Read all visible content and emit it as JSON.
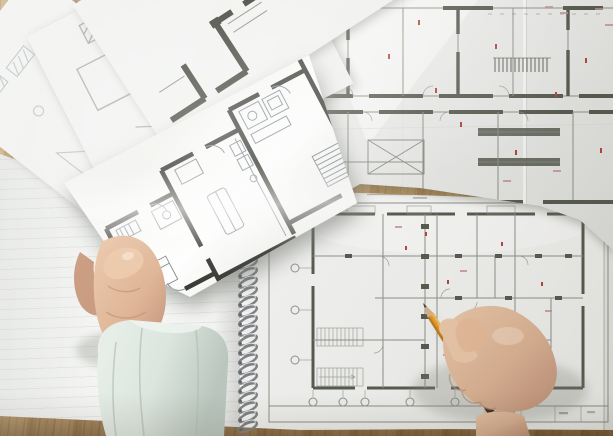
{
  "scene": {
    "description": "Top view of an architect's desk: a left hand holds a small white sheet with a bold black apartment floor plan above large technical blueprints; a right hand with a yellow pencil points at a spiral-bound blueprint pad; loose sketch sheets fan out over a wooden desktop.",
    "objects": [
      "wooden desk surface",
      "fanned loose sketch sheets",
      "large folded blueprint sheet with red corrections",
      "spiral-bound blueprint pad with title block and grid bubbles",
      "hand-held floor plan sheet with three apartment units",
      "left hand with light mint shirt cuff",
      "right hand holding yellow pencil"
    ]
  },
  "colors": {
    "wood": "#b9935f",
    "wood-dark": "#8e6c3f",
    "paper": "#f2f3f1",
    "base-paper": "#f6f7f5",
    "paper-bright": "#fdfdfc",
    "line": "#8d9289",
    "line-light": "#a7acab",
    "sketch": "#b9c3c8",
    "wall": "#565b50",
    "wall-black": "#3b3c37",
    "wall-c": "#45483f",
    "furn": "#87919a",
    "red": "#b2463e",
    "pink": "#c49096",
    "skin": "#dfb597",
    "skin-shadow": "#c2937a",
    "skin-light": "#ecc9ab",
    "cuff": "#dde7e0",
    "cuff-shadow": "#bcc9c1",
    "pencil-light": "#f2bb4e",
    "pencil-mid": "#e89a2a",
    "pencil-dark": "#c07d1c",
    "pencil-band": "#5d3a24",
    "pencil-wood": "#d9b289",
    "graphite": "#3f3e3a",
    "coil": "#7f8386"
  }
}
